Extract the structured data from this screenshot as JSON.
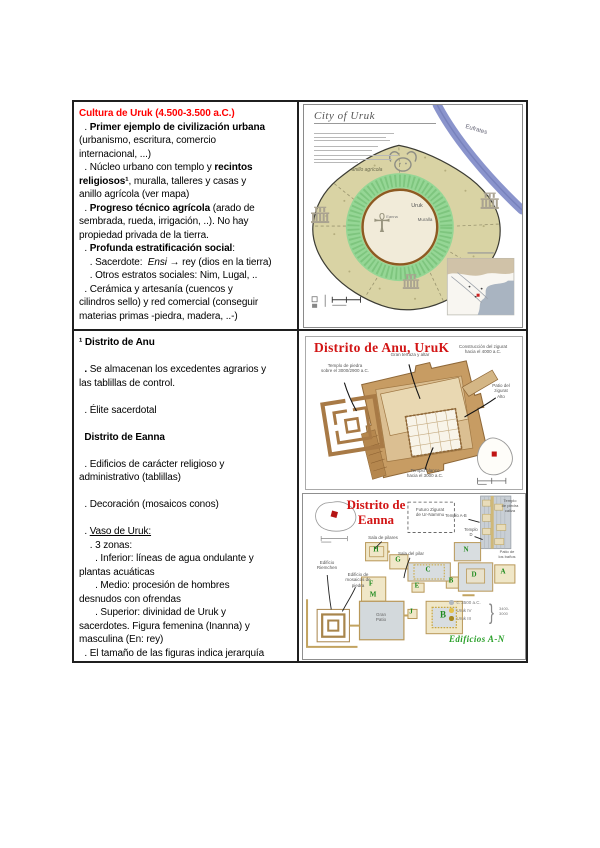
{
  "document": {
    "uruk_cell": {
      "lines": [
        [
          {
            "t": "Cultura de Uruk (4.500-3.500 a.C.)",
            "s": "br"
          }
        ],
        [
          {
            "t": "  . ",
            "s": ""
          },
          {
            "t": "Primer ejemplo de civilización urbana",
            "s": "b"
          }
        ],
        [
          {
            "t": "(urbanismo, escritura, comercio",
            "s": ""
          }
        ],
        [
          {
            "t": "internacional, ...)",
            "s": ""
          }
        ],
        [
          {
            "t": "  . Núcleo urbano con templo y ",
            "s": ""
          },
          {
            "t": "recintos",
            "s": "b"
          }
        ],
        [
          {
            "t": "religiosos¹",
            "s": "b"
          },
          {
            "t": ", muralla, talleres y casas y",
            "s": ""
          }
        ],
        [
          {
            "t": "anillo agrícola (ver mapa)",
            "s": ""
          }
        ],
        [
          {
            "t": "  . ",
            "s": ""
          },
          {
            "t": "Progreso técnico agrícola",
            "s": "b"
          },
          {
            "t": " (arado de",
            "s": ""
          }
        ],
        [
          {
            "t": "sembrada, rueda, irrigación, ..). No hay",
            "s": ""
          }
        ],
        [
          {
            "t": "propiedad privada de la tierra.",
            "s": ""
          }
        ],
        [
          {
            "t": "  . ",
            "s": ""
          },
          {
            "t": "Profunda estratificación social",
            "s": "b"
          },
          {
            "t": ":",
            "s": ""
          }
        ],
        [
          {
            "t": "    . Sacerdote:  ",
            "s": ""
          },
          {
            "t": "Ensi",
            "s": "i"
          },
          {
            "t": " → rey (dios en la tierra)",
            "s": ""
          }
        ],
        [
          {
            "t": "    . Otros estratos sociales: Nim, Lugal, ..",
            "s": ""
          }
        ],
        [
          {
            "t": "  . Cerámica y artesanía (cuencos y",
            "s": ""
          }
        ],
        [
          {
            "t": "cilindros sello) y red comercial (conseguir",
            "s": ""
          }
        ],
        [
          {
            "t": "materias primas -piedra, madera, ..-)",
            "s": ""
          }
        ]
      ]
    },
    "districts_cell": {
      "lines": [
        [
          {
            "t": "¹ Distrito de Anu",
            "s": "b"
          }
        ],
        [],
        [
          {
            "t": "  ",
            "s": ""
          },
          {
            "t": ". ",
            "s": "b"
          },
          {
            "t": "Se almacenan los excedentes agrarios y",
            "s": ""
          }
        ],
        [
          {
            "t": "las tablillas de control.",
            "s": ""
          }
        ],
        [],
        [
          {
            "t": "  . Élite sacerdotal",
            "s": ""
          }
        ],
        [],
        [
          {
            "t": "  Distrito de Eanna",
            "s": "b"
          }
        ],
        [],
        [
          {
            "t": "  . Edificios de carácter religioso y",
            "s": ""
          }
        ],
        [
          {
            "t": "administrativo (tablillas)",
            "s": ""
          }
        ],
        [],
        [
          {
            "t": "  . Decoración (mosaicos conos)",
            "s": ""
          }
        ],
        [],
        [
          {
            "t": "  . ",
            "s": ""
          },
          {
            "t": "Vaso de Uruk:",
            "s": "u"
          }
        ],
        [
          {
            "t": "    . 3 zonas:",
            "s": ""
          }
        ],
        [
          {
            "t": "      . Inferior: líneas de agua ondulante y",
            "s": ""
          }
        ],
        [
          {
            "t": "plantas acuáticas",
            "s": ""
          }
        ],
        [
          {
            "t": "      . Medio: procesión de hombres",
            "s": ""
          }
        ],
        [
          {
            "t": "desnudos con ofrendas",
            "s": ""
          }
        ],
        [
          {
            "t": "      . Superior: divinidad de Uruk y",
            "s": ""
          }
        ],
        [
          {
            "t": "sacerdotes. Figura femenina (Inanna) y",
            "s": ""
          }
        ],
        [
          {
            "t": "masculina (En: rey)",
            "s": ""
          }
        ],
        [
          {
            "t": "  . El tamaño de las figuras indica jerarquía",
            "s": ""
          }
        ]
      ]
    }
  },
  "city_map": {
    "title": "City of Uruk",
    "labels": {
      "river": "Eufrates",
      "ring": "anillo agrícola",
      "city": "Uruk",
      "wall": "Muralla",
      "district": "Eanna"
    },
    "icons": {
      "ankh": "☥"
    }
  },
  "anu_map": {
    "title": "Distrito de Anu, UruK",
    "labels": {
      "construction": "Construcción del zigurat\nhacia el 4000 a.C.",
      "stone_temple": "Templo de piedra\nsobre el 3000/2900 a.C.",
      "terrace": "Gran terraza y altar",
      "patio": "Patio del\nzigurat\nAlto",
      "white_temple": "Templo blanco\nhacia el 3000 a.C."
    }
  },
  "eanna_map": {
    "title": "Distrito de\nEanna",
    "labels": {
      "future_ziggurat": "Futuro Zigurat\nde Ur-Nammu",
      "temple_ab": "Templo A-B",
      "temple_d": "Templo\nD",
      "limestone": "Templo\nde piedra\ncaliza",
      "pillars_hall": "Sala de pilares",
      "pillar": "Sala del pilar",
      "baths": "Patio de\nlos baños",
      "riemchen": "Edificio\nRiemchen",
      "mosaics": "Edificio de\nmosaicos de piedra",
      "court": "Gran\nPatio"
    },
    "letters": [
      {
        "t": "H",
        "x": 73,
        "y": 56
      },
      {
        "t": "G",
        "x": 95,
        "y": 66
      },
      {
        "t": "C",
        "x": 125,
        "y": 76
      },
      {
        "t": "N",
        "x": 163,
        "y": 56
      },
      {
        "t": "A",
        "x": 200,
        "y": 78
      },
      {
        "t": "B",
        "x": 148,
        "y": 87
      },
      {
        "t": "D",
        "x": 171,
        "y": 81
      },
      {
        "t": "E",
        "x": 114,
        "y": 92
      },
      {
        "t": "F",
        "x": 68,
        "y": 90
      },
      {
        "t": "M",
        "x": 70,
        "y": 101
      },
      {
        "t": "J",
        "x": 108,
        "y": 118
      },
      {
        "t": "B",
        "x": 140,
        "y": 121,
        "big": true
      }
    ],
    "legend": [
      {
        "label": "c. 3500 a.C.",
        "color": "#b2b8be"
      },
      {
        "label": "Uruk IV",
        "color": "#e3c14a"
      },
      {
        "label": "Uruk III",
        "color": "#a8891f"
      }
    ],
    "bracket": "3400-\n3000",
    "edificios": "Edificios A-N",
    "icons": {
      "brace": "}"
    }
  }
}
